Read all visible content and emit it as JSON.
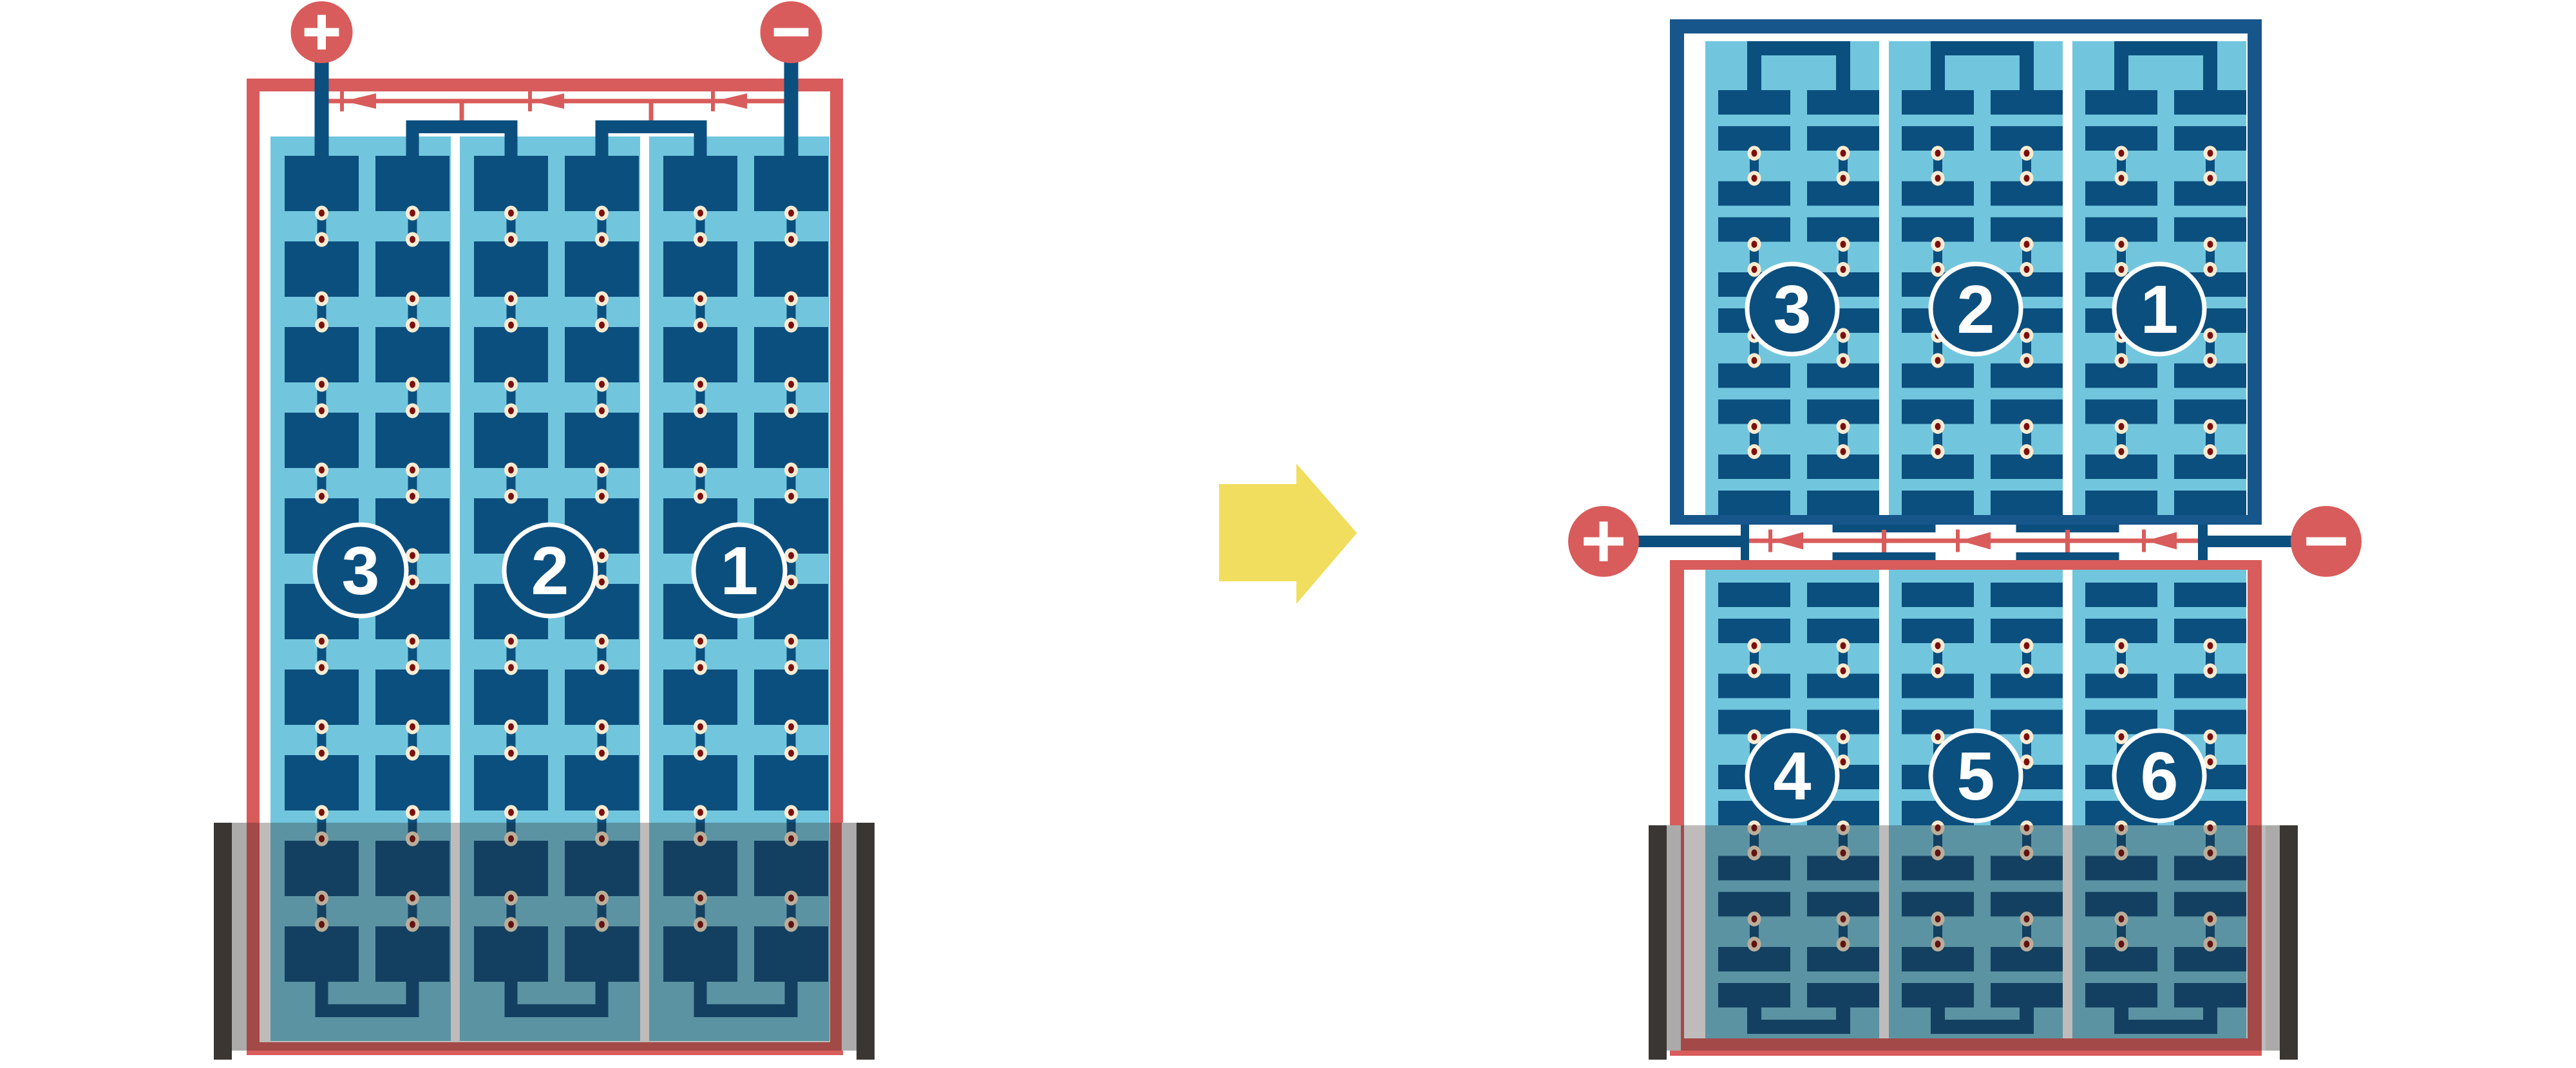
{
  "diagram_title_hidden": "",
  "colors": {
    "red": "#D85C5B",
    "dark_blue": "#0B4F7E",
    "frame_blue": "#16568B",
    "light_blue": "#71C6DE",
    "dot_outer": "#F9ECD2",
    "dot_inner": "#7C0F0D",
    "white": "#FFFFFF",
    "shade_overlay": "rgba(40,30,25,0.30)",
    "shade_bar_dark": "#393633",
    "shade_bar_light": "#ABABAB",
    "arrow_yellow": "#F1DD5E"
  },
  "left_panel": {
    "terminals": {
      "positive": "+",
      "negative": "−"
    },
    "string_labels": [
      "3",
      "2",
      "1"
    ],
    "string_count": 3,
    "cell_rows": 10,
    "cell_columns_per_string": 2,
    "bypass_diode_count": 3,
    "shade_present": true
  },
  "transform_arrow": {
    "direction": "right"
  },
  "right_panel": {
    "terminals": {
      "positive": "+",
      "negative": "−"
    },
    "top_string_labels": [
      "3",
      "2",
      "1"
    ],
    "bottom_string_labels": [
      "4",
      "5",
      "6"
    ],
    "string_count": 3,
    "cell_row_pairs_per_half": 5,
    "bypass_diode_count": 3,
    "shade_present": true
  }
}
